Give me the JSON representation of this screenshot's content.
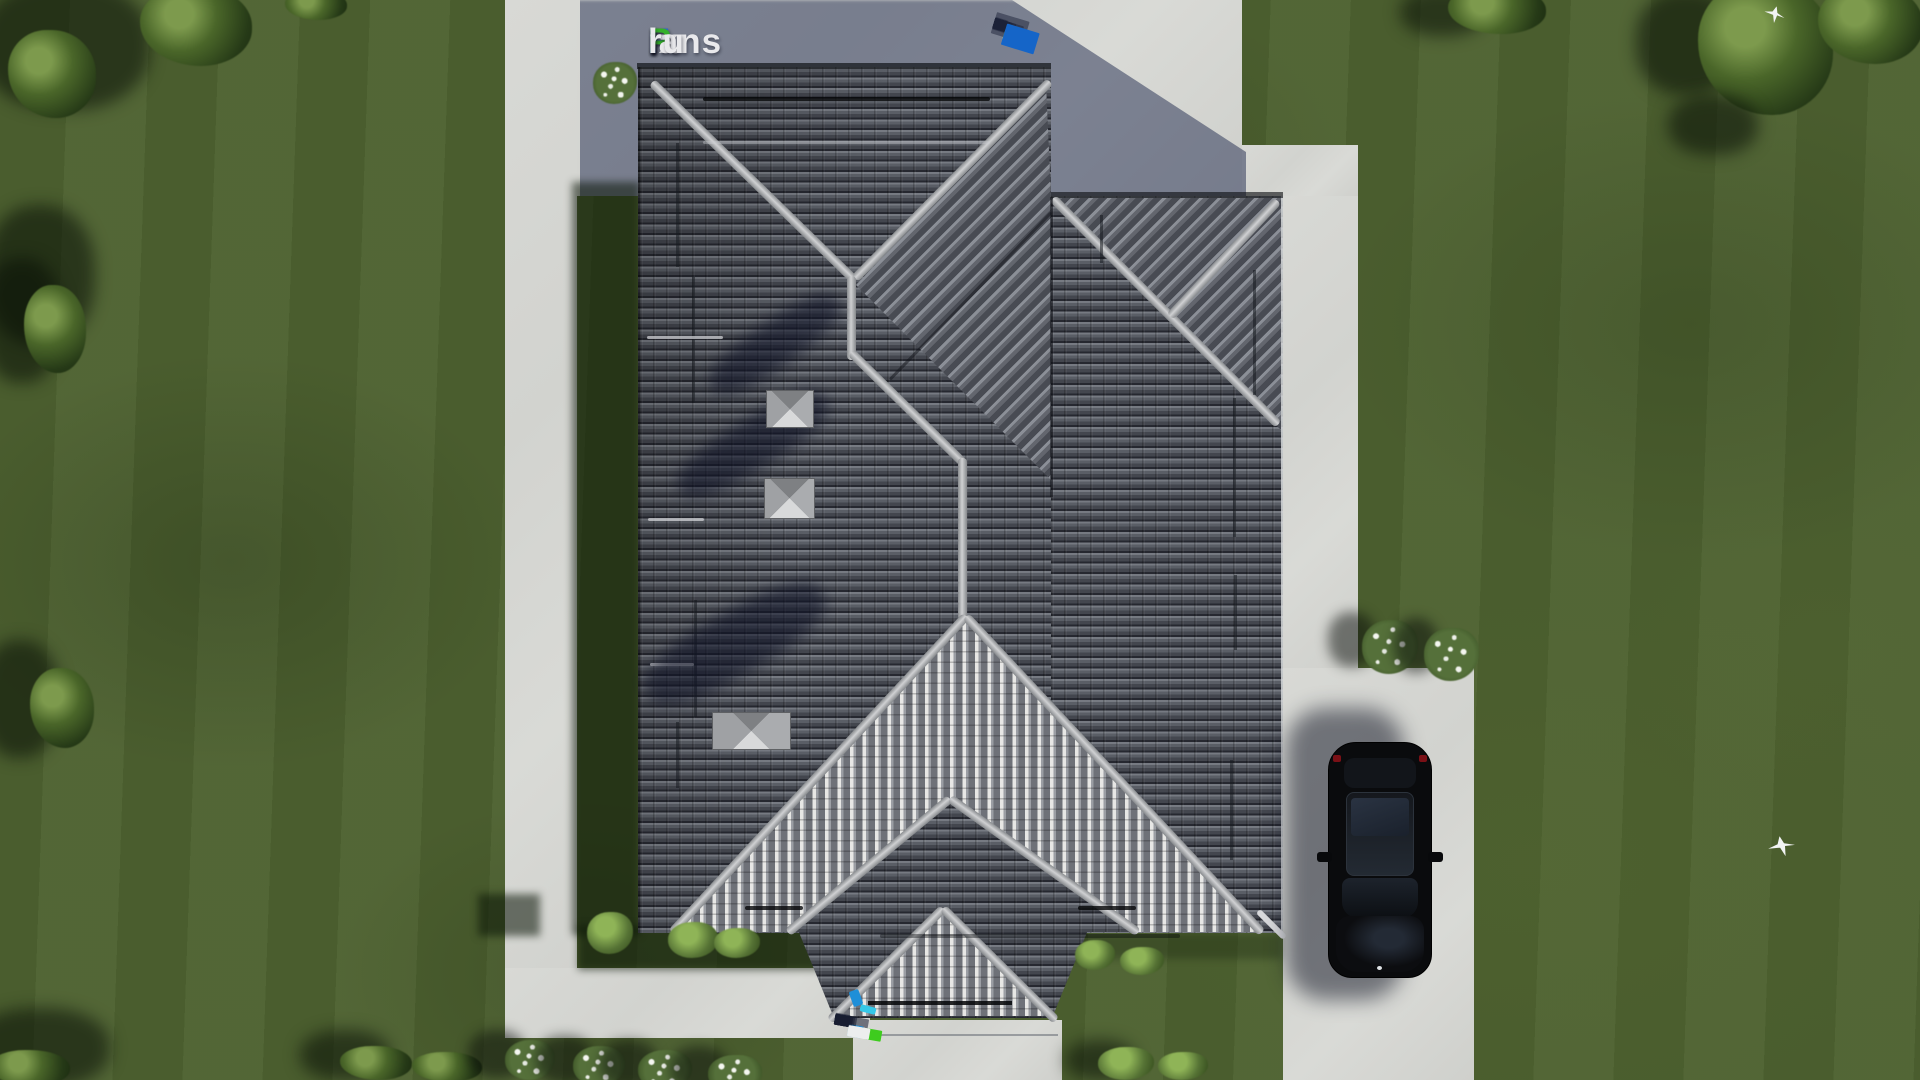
{
  "branding": {
    "logo_full": "FixPlans.ru",
    "logo_f": "F",
    "logo_ix": "ix",
    "logo_p": "P",
    "logo_lans": "lans",
    "logo_dot": ".",
    "logo_ru": "ru"
  },
  "palette": {
    "grass": "#4d6130",
    "grass_shadow": "#20301a",
    "concrete": "#d6d7d3",
    "concrete_shadow": "#6b7390",
    "roof_tile_dark": "#43464e",
    "roof_tile_light": "#767a82",
    "ridge_cap": "#d0d1d3",
    "chevron_stripe": "#e7e7e5",
    "logo_blue": "#2e6ad1",
    "logo_green": "#35b02a",
    "logo_white": "#e9e9ec",
    "watermark_blue": "#1f6fd0",
    "watermark_green": "#3ecc1e",
    "car_body": "#0a0b0d"
  },
  "scene": {
    "chimneys": 3,
    "birds": 2,
    "vehicles": 1
  }
}
